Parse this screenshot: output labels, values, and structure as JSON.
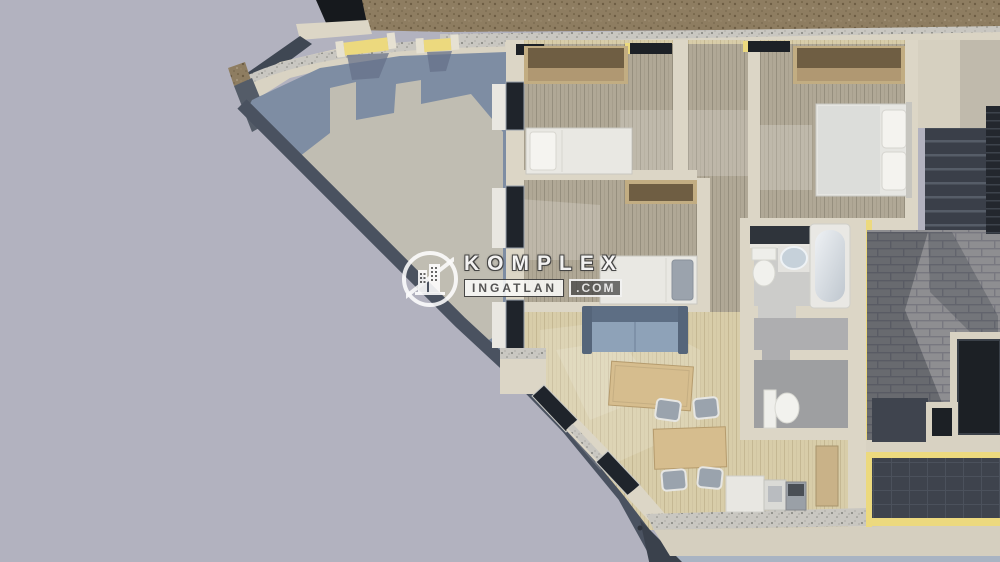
{
  "watermark": {
    "brand": "KOMPLEX",
    "brand_sub": "INGATLAN",
    "brand_tld": ".COM",
    "logo_icon": "buildings-badge-icon"
  },
  "scene": {
    "description": "3D cutaway floor-plan render of an attic apartment with front terrace, three bedrooms, bathroom, WC, living-dining-kitchen, stair landing and rear roof terraces",
    "colors": {
      "background": "#b2b2bf",
      "terrace_floor": "#7e8da3",
      "terrace_shadow": "#c0bdb2",
      "wall_cream": "#dcd6c6",
      "wall_speckle": "#c9c7c1",
      "insulation_yellow": "#ecd97e",
      "wood_floor_light": "#d8cda9",
      "wood_floor_gray": "#b0a896",
      "brick_paver": "#8e8e91",
      "dark_roof": "#3e434d",
      "window_glass": "#1f242b",
      "sofa_blue": "#8ea2b8",
      "furniture_tan": "#d6bd8e",
      "exterior_wall_brown": "#8e7d61",
      "ground_shadow": "#a9b4c3"
    },
    "rooms": [
      "front-terrace",
      "bedroom-1",
      "bedroom-2",
      "bedroom-3",
      "corridor",
      "bathroom",
      "wc",
      "living-dining-kitchen",
      "stair-landing",
      "roof-terrace"
    ],
    "furniture": [
      "single-bed",
      "single-bed",
      "double-bed",
      "wardrobes",
      "sofa",
      "coffee-table",
      "dining-table",
      "dining-chairs",
      "bathtub",
      "toilets",
      "washbasin",
      "kitchen-counter",
      "staircase"
    ]
  }
}
